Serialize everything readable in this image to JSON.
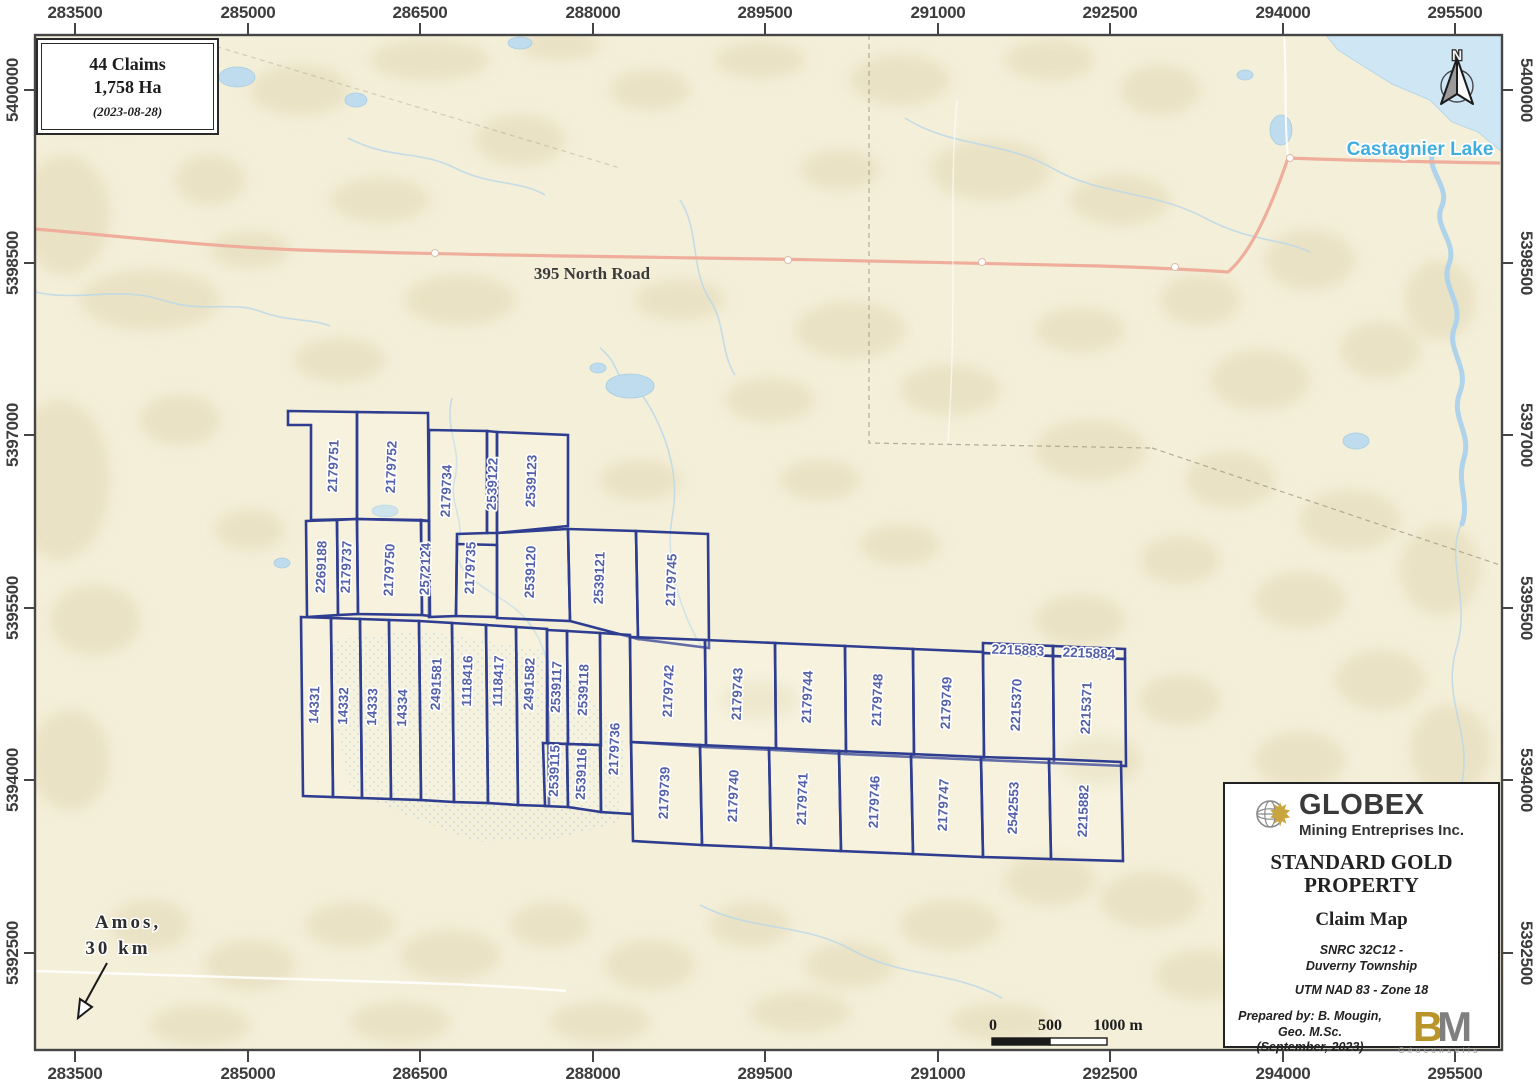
{
  "info_box": {
    "claims": "44 Claims",
    "area": "1,758 Ha",
    "date": "(2023-08-28)"
  },
  "axes": {
    "top": [
      "283500",
      "285000",
      "286500",
      "288000",
      "289500",
      "291000",
      "292500",
      "294000",
      "295500"
    ],
    "bottom": [
      "283500",
      "285000",
      "286500",
      "288000",
      "289500",
      "291000",
      "292500",
      "294000",
      "295500"
    ],
    "left": [
      "5400000",
      "5398500",
      "5397000",
      "5395500",
      "5394000",
      "5392500"
    ],
    "right": [
      "5400000",
      "5398500",
      "5397000",
      "5395500",
      "5394000",
      "5392500"
    ]
  },
  "map": {
    "road_label": "395 North Road",
    "lake_label": "Castagnier Lake",
    "amos_line1": "Amos,",
    "amos_line2": "30 km",
    "north_label": "N",
    "accent_claim_line": "#2f3d90",
    "accent_claim_text": "#5460a8",
    "road_color": "#efae9b",
    "water_color": "#cfe6f4"
  },
  "scalebar": {
    "t0": "0",
    "t500": "500",
    "t1000": "1000 m"
  },
  "title_block": {
    "company": "GLOBEX",
    "company_sub": "Mining Entreprises Inc.",
    "title_line1": "STANDARD GOLD",
    "title_line2": "PROPERTY",
    "subtitle": "Claim Map",
    "snrc_line1": "SNRC 32C12 -",
    "snrc_line2": "Duverny Township",
    "datum": "UTM NAD 83 - Zone 18",
    "prepared_line1": "Prepared by: B. Mougin,",
    "prepared_line2": "Geo. M.Sc.",
    "prepared_line3": "(September, 2023)",
    "bm_b": "B",
    "bm_m": "M",
    "bm_sub": "Géoconseils"
  },
  "claims": [
    {
      "label": "2179751",
      "poly": [
        288,
        411,
        357,
        412,
        357,
        519,
        311,
        520,
        311,
        425,
        288,
        425
      ],
      "lp": [
        333,
        466
      ],
      "o": "v"
    },
    {
      "label": "2179752",
      "poly": [
        357,
        412,
        428,
        413,
        429,
        521,
        357,
        519
      ],
      "lp": [
        391,
        467
      ],
      "o": "v"
    },
    {
      "label": "2179734",
      "poly": [
        429,
        430,
        487,
        431,
        487,
        533,
        457,
        534,
        456,
        616,
        429,
        617,
        429,
        521
      ],
      "lp": [
        446,
        491
      ],
      "o": "v"
    },
    {
      "label": "2539122",
      "poly": [
        487,
        431,
        497,
        432,
        497,
        533,
        487,
        533
      ],
      "lp": [
        492,
        484
      ],
      "o": "v"
    },
    {
      "label": "2539123",
      "poly": [
        497,
        432,
        568,
        435,
        568,
        526,
        497,
        533
      ],
      "lp": [
        531,
        481
      ],
      "o": "v"
    },
    {
      "label": "2269188",
      "poly": [
        306,
        521,
        337,
        520,
        338,
        615,
        307,
        617
      ],
      "lp": [
        321,
        567
      ],
      "o": "v"
    },
    {
      "label": "2179737",
      "poly": [
        337,
        520,
        357,
        519,
        358,
        614,
        338,
        615
      ],
      "lp": [
        346,
        567
      ],
      "o": "v"
    },
    {
      "label": "2179750",
      "poly": [
        357,
        519,
        421,
        520,
        422,
        615,
        358,
        614
      ],
      "lp": [
        389,
        570
      ],
      "o": "v"
    },
    {
      "label": "2572124",
      "poly": [
        421,
        520,
        429,
        521,
        430,
        616,
        422,
        615
      ],
      "lp": [
        425,
        569
      ],
      "o": "v"
    },
    {
      "label": "2179735",
      "poly": [
        457,
        544,
        497,
        545,
        497,
        617,
        456,
        616
      ],
      "lp": [
        470,
        568
      ],
      "o": "v"
    },
    {
      "label": "2539120",
      "poly": [
        497,
        533,
        568,
        529,
        570,
        621,
        497,
        618
      ],
      "lp": [
        530,
        572
      ],
      "o": "v"
    },
    {
      "label": "2539121",
      "poly": [
        568,
        529,
        636,
        531,
        638,
        639,
        570,
        621
      ],
      "lp": [
        599,
        578
      ],
      "o": "v"
    },
    {
      "label": "2179745",
      "poly": [
        636,
        531,
        708,
        534,
        709,
        648,
        638,
        639
      ],
      "lp": [
        671,
        580
      ],
      "o": "v"
    },
    {
      "label": "14331",
      "poly": [
        301,
        617,
        331,
        618,
        333,
        797,
        303,
        796
      ],
      "lp": [
        314,
        705
      ],
      "o": "v"
    },
    {
      "label": "14332",
      "poly": [
        331,
        618,
        360,
        619,
        362,
        798,
        333,
        797
      ],
      "lp": [
        343,
        706
      ],
      "o": "v"
    },
    {
      "label": "14333",
      "poly": [
        360,
        619,
        389,
        620,
        391,
        799,
        362,
        798
      ],
      "lp": [
        372,
        707
      ],
      "o": "v"
    },
    {
      "label": "14334",
      "poly": [
        389,
        620,
        419,
        621,
        421,
        800,
        391,
        799
      ],
      "lp": [
        402,
        708
      ],
      "o": "v"
    },
    {
      "label": "2491581",
      "poly": [
        419,
        621,
        452,
        623,
        454,
        802,
        421,
        800
      ],
      "lp": [
        436,
        684
      ],
      "o": "v"
    },
    {
      "label": "1118416",
      "poly": [
        452,
        623,
        486,
        625,
        488,
        803,
        454,
        802
      ],
      "lp": [
        467,
        681
      ],
      "o": "v"
    },
    {
      "label": "1118417",
      "poly": [
        486,
        625,
        516,
        627,
        518,
        805,
        488,
        803
      ],
      "lp": [
        498,
        681
      ],
      "o": "v"
    },
    {
      "label": "2491582",
      "poly": [
        516,
        627,
        547,
        629,
        549,
        806,
        518,
        805
      ],
      "lp": [
        529,
        684
      ],
      "o": "v"
    },
    {
      "label": "2539117",
      "poly": [
        547,
        630,
        567,
        631,
        568,
        744,
        547,
        743
      ],
      "lp": [
        556,
        687
      ],
      "o": "v"
    },
    {
      "label": "2539118",
      "poly": [
        567,
        631,
        600,
        633,
        601,
        745,
        568,
        744
      ],
      "lp": [
        583,
        690
      ],
      "o": "v"
    },
    {
      "label": "2539115",
      "poly": [
        543,
        743,
        567,
        744,
        568,
        807,
        545,
        806
      ],
      "lp": [
        554,
        771
      ],
      "o": "v"
    },
    {
      "label": "2539116",
      "poly": [
        567,
        744,
        600,
        745,
        601,
        812,
        568,
        807
      ],
      "lp": [
        581,
        774
      ],
      "o": "v"
    },
    {
      "label": "2179736",
      "poly": [
        600,
        633,
        630,
        635,
        632,
        814,
        601,
        812
      ],
      "lp": [
        614,
        749
      ],
      "o": "v"
    },
    {
      "label": "2179742",
      "poly": [
        630,
        637,
        705,
        640,
        706,
        747,
        631,
        742
      ],
      "lp": [
        668,
        691
      ],
      "o": "v"
    },
    {
      "label": "2179743",
      "poly": [
        705,
        640,
        775,
        643,
        776,
        750,
        706,
        747
      ],
      "lp": [
        737,
        694
      ],
      "o": "v"
    },
    {
      "label": "2179744",
      "poly": [
        775,
        643,
        845,
        646,
        846,
        754,
        776,
        750
      ],
      "lp": [
        807,
        697
      ],
      "o": "v"
    },
    {
      "label": "2179748",
      "poly": [
        845,
        646,
        913,
        649,
        914,
        757,
        846,
        754
      ],
      "lp": [
        877,
        700
      ],
      "o": "v"
    },
    {
      "label": "2179749",
      "poly": [
        913,
        649,
        983,
        652,
        984,
        760,
        914,
        757
      ],
      "lp": [
        946,
        703
      ],
      "o": "v"
    },
    {
      "label": "2215883",
      "poly": [
        983,
        643,
        1053,
        646,
        1053,
        656,
        983,
        653
      ],
      "lp": [
        1018,
        650
      ],
      "o": "h"
    },
    {
      "label": "2215884",
      "poly": [
        1053,
        646,
        1125,
        649,
        1125,
        659,
        1053,
        656
      ],
      "lp": [
        1089,
        653
      ],
      "o": "h"
    },
    {
      "label": "2215370",
      "poly": [
        983,
        653,
        1053,
        656,
        1054,
        763,
        984,
        760
      ],
      "lp": [
        1016,
        705
      ],
      "o": "v"
    },
    {
      "label": "2215371",
      "poly": [
        1053,
        656,
        1125,
        659,
        1126,
        766,
        1054,
        763
      ],
      "lp": [
        1086,
        708
      ],
      "o": "v"
    },
    {
      "label": "2179739",
      "poly": [
        631,
        742,
        700,
        745,
        702,
        845,
        633,
        841
      ],
      "lp": [
        664,
        793
      ],
      "o": "v"
    },
    {
      "label": "2179740",
      "poly": [
        700,
        745,
        769,
        748,
        771,
        848,
        702,
        845
      ],
      "lp": [
        733,
        796
      ],
      "o": "v"
    },
    {
      "label": "2179741",
      "poly": [
        769,
        748,
        839,
        751,
        841,
        851,
        771,
        848
      ],
      "lp": [
        802,
        799
      ],
      "o": "v"
    },
    {
      "label": "2179746",
      "poly": [
        839,
        751,
        911,
        754,
        913,
        854,
        841,
        851
      ],
      "lp": [
        874,
        802
      ],
      "o": "v"
    },
    {
      "label": "2179747",
      "poly": [
        911,
        754,
        981,
        757,
        983,
        857,
        913,
        854
      ],
      "lp": [
        943,
        805
      ],
      "o": "v"
    },
    {
      "label": "2542553",
      "poly": [
        981,
        757,
        1049,
        759,
        1051,
        859,
        983,
        857
      ],
      "lp": [
        1013,
        808
      ],
      "o": "v"
    },
    {
      "label": "2215882",
      "poly": [
        1049,
        759,
        1121,
        762,
        1123,
        861,
        1051,
        859
      ],
      "lp": [
        1083,
        811
      ],
      "o": "v"
    }
  ]
}
